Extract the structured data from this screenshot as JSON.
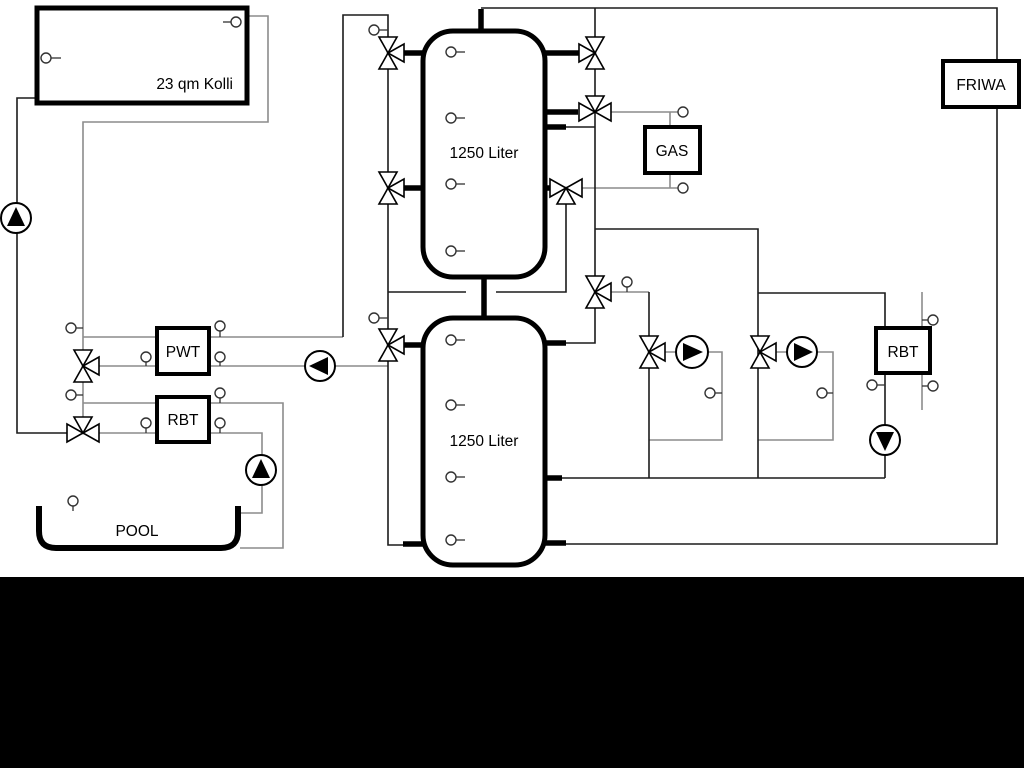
{
  "diagram": {
    "type": "hydraulic-schematic",
    "labels": {
      "collector": "23 qm Kolli",
      "tank1": "1250 Liter",
      "tank2": "1250 Liter",
      "pwt": "PWT",
      "rbt_left": "RBT",
      "gas": "GAS",
      "friwa": "FRIWA",
      "rbt_right": "RBT",
      "pool": "POOL"
    },
    "components": [
      {
        "id": "collector",
        "type": "solar-collector",
        "label": "23 qm Kolli"
      },
      {
        "id": "buffer-tank-1",
        "type": "storage-tank",
        "label": "1250 Liter"
      },
      {
        "id": "buffer-tank-2",
        "type": "storage-tank",
        "label": "1250 Liter"
      },
      {
        "id": "pwt",
        "type": "heat-exchanger",
        "label": "PWT"
      },
      {
        "id": "rbt-left",
        "type": "heat-exchanger",
        "label": "RBT"
      },
      {
        "id": "gas-boiler",
        "type": "boiler",
        "label": "GAS"
      },
      {
        "id": "friwa",
        "type": "fresh-water-module",
        "label": "FRIWA"
      },
      {
        "id": "rbt-right",
        "type": "heat-exchanger",
        "label": "RBT"
      },
      {
        "id": "pool",
        "type": "swimming-pool",
        "label": "POOL"
      }
    ],
    "symbol_counts": {
      "pumps": 6,
      "three_way_valves": 11,
      "sensors": 29
    },
    "colors": {
      "background": "#ffffff",
      "outline": "#000000",
      "pipe_dark": "#1c1c1c",
      "pipe_gray": "#8c8c8c",
      "bottom_mask": "#000000"
    }
  }
}
